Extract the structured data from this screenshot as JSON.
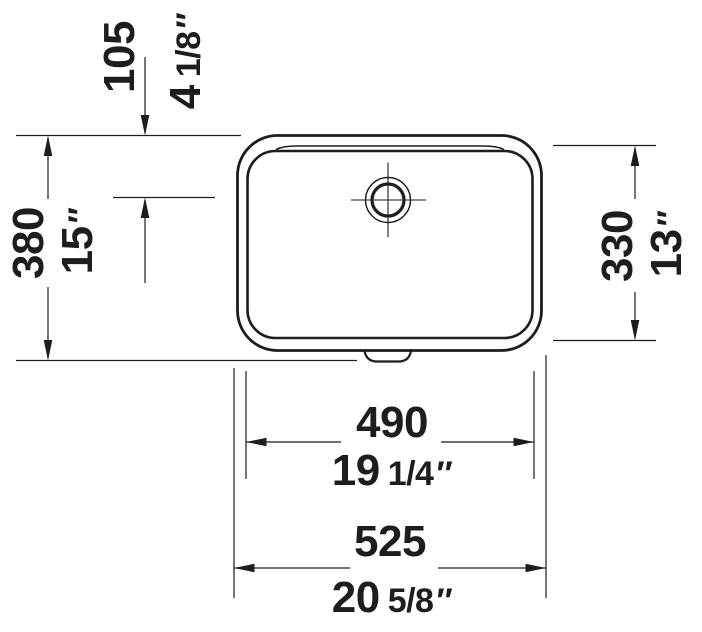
{
  "drawing": {
    "kind": "basin plan-view technical drawing",
    "background": "#ffffff",
    "ink": "#1d1d1b"
  },
  "dimensions": {
    "hole_offset": {
      "mm": "105",
      "inch_whole": "4",
      "inch_frac": "1/8",
      "inch_mark": "″"
    },
    "overall_depth": {
      "mm": "380",
      "inch_whole": "15",
      "inch_frac": "",
      "inch_mark": "″"
    },
    "inner_depth": {
      "mm": "330",
      "inch_whole": "13",
      "inch_frac": "",
      "inch_mark": "″"
    },
    "inner_width": {
      "mm": "490",
      "inch_whole": "19",
      "inch_frac": "1/4",
      "inch_mark": "″"
    },
    "overall_width": {
      "mm": "525",
      "inch_whole": "20",
      "inch_frac": "5/8",
      "inch_mark": "″"
    }
  }
}
